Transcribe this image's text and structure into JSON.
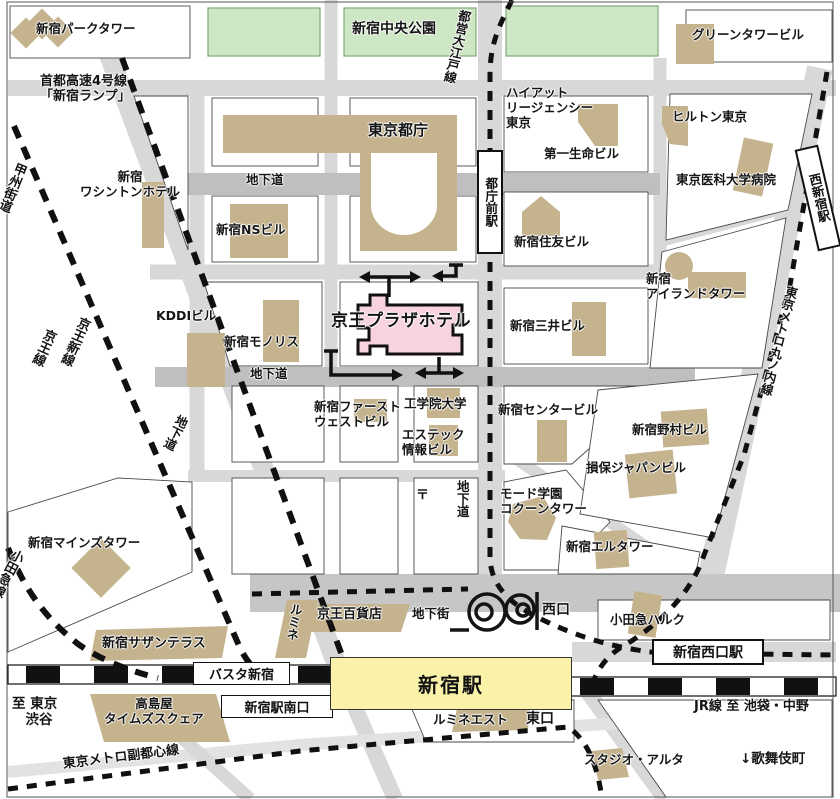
{
  "map": {
    "colors": {
      "road": "#d8d8d8",
      "underpass_road": "#bfbfbf",
      "plaza_road": "#c6c6c6",
      "building_tan": "#c5b38e",
      "park_green": "#cde6c3",
      "hotel_pink": "#f8d2dc",
      "station_yellow": "#f9f2a8",
      "rail_black": "#111111",
      "outline": "#4a4a4a"
    },
    "labels": {
      "park_tower": "新宿パークタワー",
      "shuto_expwy": "首都高速4号線\n「新宿ランプ」",
      "chuo_park": "新宿中央公園",
      "green_tower": "グリーンタワービル",
      "oedo_line": "都営大江戸線",
      "hyatt": "ハイアット\nリージェンシー\n東京",
      "hilton": "ヒルトン東京",
      "daiichi_seimei": "第一生命ビル",
      "tokyo_medical": "東京医科大学病院",
      "nishi_shinjuku_sta": "西新宿駅",
      "tocho": "東京都庁",
      "underpass": "地下道",
      "washington_hotel": "新宿\nワシントンホテル",
      "koshu_kaido": "甲州街道",
      "ns_bldg": "新宿NSビル",
      "sumitomo": "新宿住友ビル",
      "tochomae_sta": "都庁前駅",
      "kddi": "KDDIビル",
      "monolith": "新宿モノリス",
      "keio_plaza": "京王プラザホテル",
      "mitsui": "新宿三井ビル",
      "island_tower": "新宿\nアイランドタワー",
      "marunouchi_line": "東京メトロ丸ノ内線",
      "keio_line": "京王線",
      "keio_new_line": "京王新線",
      "first_west": "新宿ファースト\nウェストビル",
      "kogakuin": "工学院大学",
      "estec": "エステック\n情報ビル",
      "center_bldg": "新宿センタービル",
      "nomura": "新宿野村ビル",
      "sompo": "損保ジャパンビル",
      "post_mark": "〒",
      "mode_gakuen": "モード学園\nコクーンタワー",
      "el_tower": "新宿エルタワー",
      "mainds": "新宿マインズタワー",
      "odakyu_line": "小田急線",
      "southern_terrace": "新宿サザンテラス",
      "busta": "バスタ新宿",
      "takashimaya": "高島屋\nタイムズスクェア",
      "to_tokyo_shibuya": "至 東京\n　渋谷",
      "minamiguchi": "新宿駅南口",
      "fukutoshin_line": "東京メトロ副都心線",
      "lumine": "ルミネ",
      "keio_dept": "京王百貨店",
      "chikagai": "地下街",
      "nishiguchi": "西口",
      "shinjuku_sta": "新宿駅",
      "lumine_est": "ルミネエスト",
      "higashiguchi": "東口",
      "odakyu_halc": "小田急ハルク",
      "nishiguchi_sta": "新宿西口駅",
      "jr_to_ikebukuro": "JR線 至 池袋・中野",
      "kabukicho": "↓歌舞伎町",
      "studio_alta": "スタジオ・アルタ"
    }
  }
}
